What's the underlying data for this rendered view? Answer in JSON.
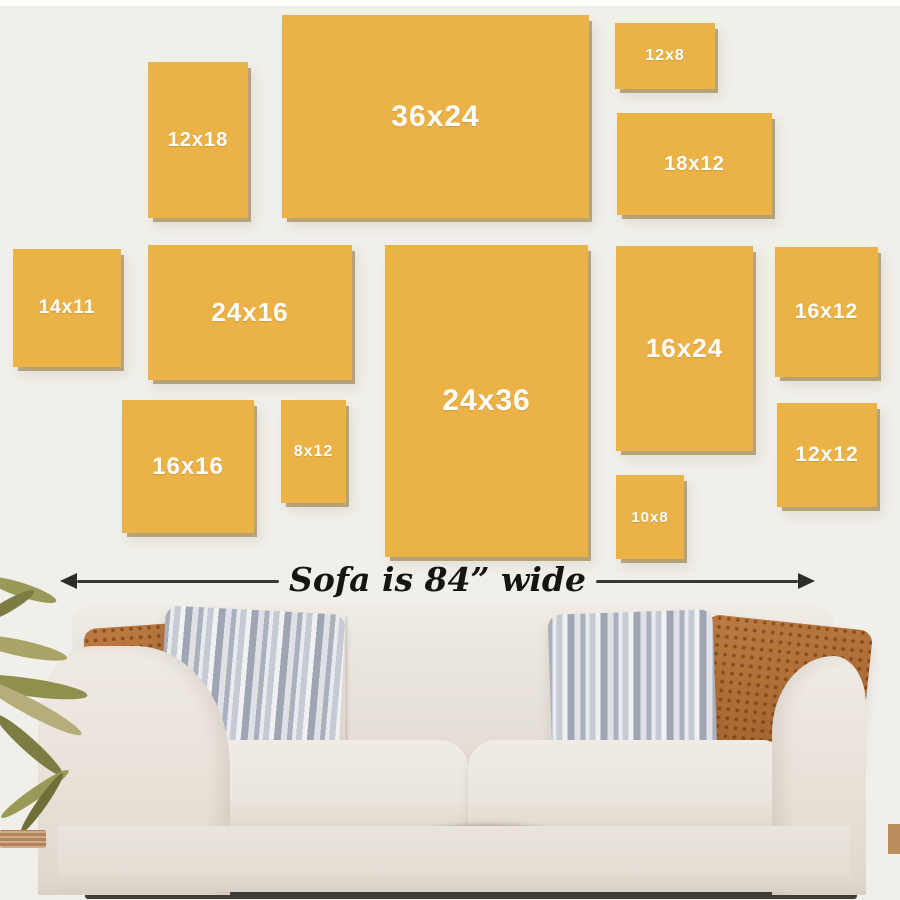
{
  "wall_art_size_guide": {
    "canvases": [
      {
        "label": "12x18",
        "x": 148,
        "y": 62,
        "w": 100,
        "h": 156,
        "fs": 20
      },
      {
        "label": "36x24",
        "x": 282,
        "y": 15,
        "w": 307,
        "h": 203,
        "fs": 30
      },
      {
        "label": "12x8",
        "x": 615,
        "y": 23,
        "w": 100,
        "h": 66,
        "fs": 16
      },
      {
        "label": "18x12",
        "x": 617,
        "y": 113,
        "w": 155,
        "h": 102,
        "fs": 20
      },
      {
        "label": "14x11",
        "x": 13,
        "y": 249,
        "w": 108,
        "h": 118,
        "fs": 19
      },
      {
        "label": "24x16",
        "x": 148,
        "y": 245,
        "w": 204,
        "h": 135,
        "fs": 26
      },
      {
        "label": "24x36",
        "x": 385,
        "y": 245,
        "w": 203,
        "h": 312,
        "fs": 30
      },
      {
        "label": "16x24",
        "x": 616,
        "y": 246,
        "w": 137,
        "h": 205,
        "fs": 26
      },
      {
        "label": "16x12",
        "x": 775,
        "y": 247,
        "w": 103,
        "h": 130,
        "fs": 21
      },
      {
        "label": "16x16",
        "x": 122,
        "y": 400,
        "w": 132,
        "h": 133,
        "fs": 24
      },
      {
        "label": "8x12",
        "x": 281,
        "y": 400,
        "w": 65,
        "h": 103,
        "fs": 16
      },
      {
        "label": "10x8",
        "x": 616,
        "y": 475,
        "w": 68,
        "h": 84,
        "fs": 15
      },
      {
        "label": "12x12",
        "x": 777,
        "y": 403,
        "w": 100,
        "h": 104,
        "fs": 21
      }
    ],
    "sofa_width_label": "Sofa is 84” wide",
    "colors": {
      "canvas": "#ebb347",
      "canvas_edge": "#8d6f2b",
      "wall": "#f1efe9",
      "label_text": "#ffffff",
      "annotation_text": "#17150f"
    }
  }
}
